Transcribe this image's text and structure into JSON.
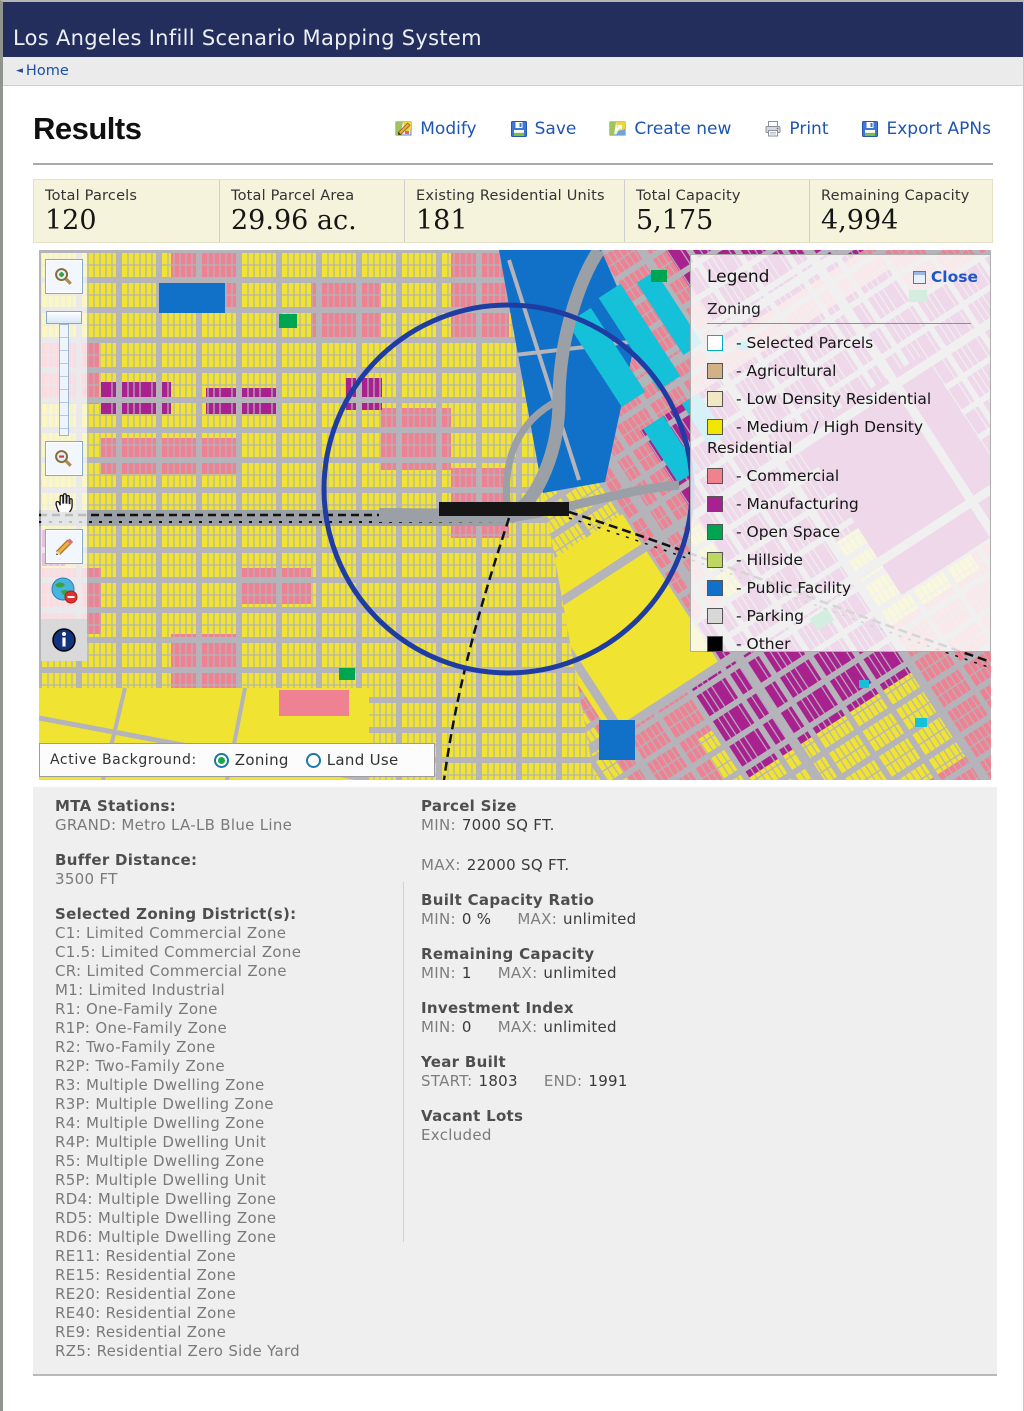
{
  "header": {
    "title": "Los Angeles Infill Scenario Mapping System"
  },
  "breadcrumb": {
    "home": "Home"
  },
  "results": {
    "title": "Results",
    "actions": [
      {
        "label": "Modify",
        "icon": "map-pencil-icon"
      },
      {
        "label": "Save",
        "icon": "floppy-disk-icon"
      },
      {
        "label": "Create new",
        "icon": "map-icon"
      },
      {
        "label": "Print",
        "icon": "printer-icon"
      },
      {
        "label": "Export APNs",
        "icon": "floppy-disk-icon"
      }
    ]
  },
  "stats": [
    {
      "label": "Total Parcels",
      "value": "120"
    },
    {
      "label": "Total Parcel Area",
      "value": "29.96 ac."
    },
    {
      "label": "Existing Residential Units",
      "value": "181"
    },
    {
      "label": "Total Capacity",
      "value": "5,175"
    },
    {
      "label": "Remaining Capacity",
      "value": "4,994"
    }
  ],
  "map": {
    "legend": {
      "title": "Legend",
      "close_label": "Close",
      "section": "Zoning",
      "items": [
        {
          "label": "- Selected Parcels",
          "color": "#FFFFFF",
          "border": "#00AEC8"
        },
        {
          "label": "- Agricultural",
          "color": "#D2B187"
        },
        {
          "label": "- Low Density Residential",
          "color": "#F0E7C3"
        },
        {
          "label": "- Medium / High Density Residential",
          "color": "#F2E500"
        },
        {
          "label": "- Commercial",
          "color": "#F08290"
        },
        {
          "label": "- Manufacturing",
          "color": "#A72191"
        },
        {
          "label": "- Open Space",
          "color": "#00A551"
        },
        {
          "label": "- Hillside",
          "color": "#BED763"
        },
        {
          "label": "- Public Facility",
          "color": "#1170C8"
        },
        {
          "label": "- Parking",
          "color": "#D8D8D8"
        },
        {
          "label": "- Other",
          "color": "#000000"
        }
      ]
    },
    "active_background": {
      "label": "Active Background:",
      "options": [
        {
          "label": "Zoning",
          "selected": true
        },
        {
          "label": "Land Use",
          "selected": false
        }
      ]
    }
  },
  "details": {
    "left": {
      "mta": {
        "heading": "MTA Stations:",
        "value": "GRAND: Metro LA-LB Blue Line"
      },
      "buffer": {
        "heading": "Buffer Distance:",
        "value": "3500 FT"
      },
      "zoning": {
        "heading": "Selected Zoning District(s):",
        "items": [
          "C1: Limited Commercial Zone",
          "C1.5: Limited Commercial Zone",
          "CR: Limited Commercial Zone",
          "M1: Limited Industrial",
          "R1: One-Family Zone",
          "R1P: One-Family Zone",
          "R2: Two-Family Zone",
          "R2P: Two-Family Zone",
          "R3: Multiple Dwelling Zone",
          "R3P: Multiple Dwelling Zone",
          "R4: Multiple Dwelling Zone",
          "R4P: Multiple Dwelling Unit",
          "R5: Multiple Dwelling Zone",
          "R5P: Multiple Dwelling Unit",
          "RD4: Multiple Dwelling Zone",
          "RD5: Multiple Dwelling Zone",
          "RD6: Multiple Dwelling Zone",
          "RE11: Residential Zone",
          "RE15: Residential Zone",
          "RE20: Residential Zone",
          "RE40: Residential Zone",
          "RE9: Residential Zone",
          "RZ5: Residential Zero Side Yard"
        ]
      }
    },
    "right": {
      "parcel_size": {
        "heading": "Parcel Size",
        "min_label": "MIN:",
        "min": "7000 SQ FT.",
        "max_label": "MAX:",
        "max": "22000 SQ FT."
      },
      "built_capacity": {
        "heading": "Built Capacity Ratio",
        "min_label": "MIN:",
        "min": "0 %",
        "max_label": "MAX:",
        "max": "unlimited"
      },
      "remaining": {
        "heading": "Remaining Capacity",
        "min_label": "MIN:",
        "min": "1",
        "max_label": "MAX:",
        "max": "unlimited"
      },
      "investment": {
        "heading": "Investment Index",
        "min_label": "MIN:",
        "min": "0",
        "max_label": "MAX:",
        "max": "unlimited"
      },
      "year_built": {
        "heading": "Year Built",
        "start_label": "START:",
        "start": "1803",
        "end_label": "END:",
        "end": "1991"
      },
      "vacant": {
        "heading": "Vacant Lots",
        "value": "Excluded"
      }
    }
  }
}
